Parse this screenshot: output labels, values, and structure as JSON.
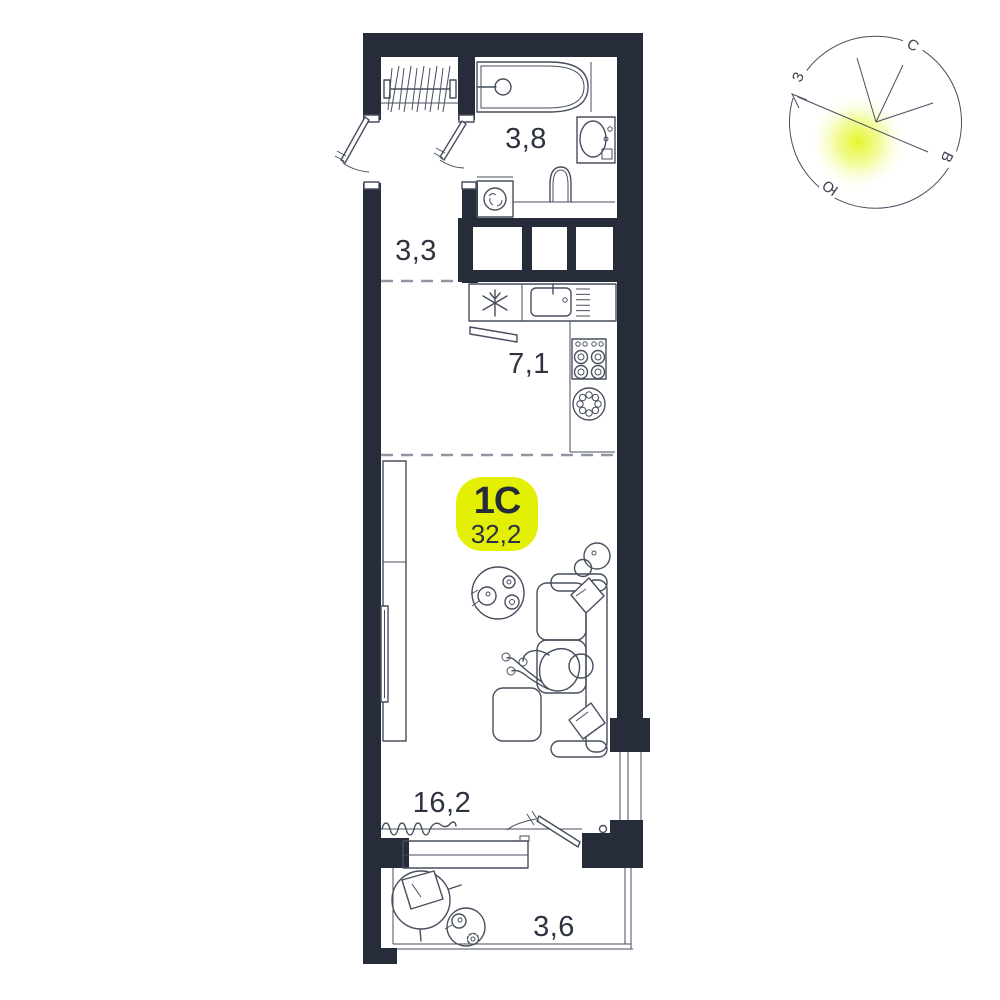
{
  "unit": {
    "type_label": "1С",
    "total_area": "32,2"
  },
  "rooms": {
    "bathroom": "3,8",
    "hallway": "3,3",
    "kitchen": "7,1",
    "living": "16,2",
    "balcony": "3,6"
  },
  "compass": {
    "north": "С",
    "east": "В",
    "south": "Ю",
    "west": "З"
  },
  "colors": {
    "wall": "#272c3a",
    "accent": "#e3f005",
    "line": "#474e5d",
    "glow": "#e9f83e"
  }
}
